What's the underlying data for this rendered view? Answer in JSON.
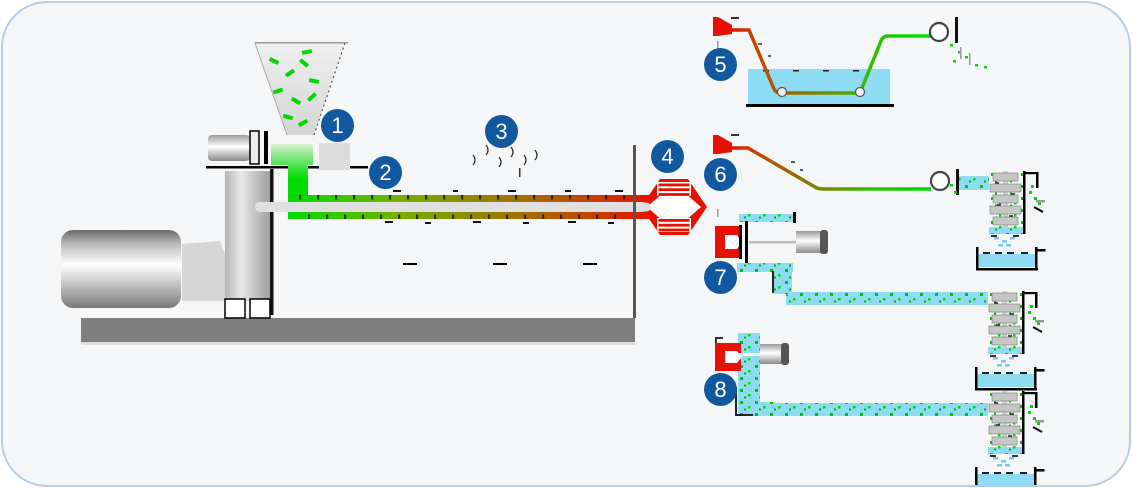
{
  "diagram": {
    "name": "plastic-extrusion-and-pelletizing-process-diagram"
  },
  "colors": {
    "badge_blue": "#11589e",
    "pellet_green": "#00d900",
    "melt_red": "#e81000",
    "water_blue": "#8edcf4",
    "machine_light_gray": "#d9d9d9",
    "base_gray": "#7f7f7f",
    "panel_bg": "#f5f6f7",
    "panel_border": "#b6cde6"
  },
  "steps": [
    {
      "number": "1",
      "name": "material-hopper"
    },
    {
      "number": "2",
      "name": "screw-and-barrel"
    },
    {
      "number": "3",
      "name": "barrel-heating"
    },
    {
      "number": "4",
      "name": "die-head"
    },
    {
      "number": "5",
      "name": "water-bath-strand-pelletizing"
    },
    {
      "number": "6",
      "name": "air-cooled-strand-pelletizing"
    },
    {
      "number": "7",
      "name": "water-ring-pelletizing"
    },
    {
      "number": "8",
      "name": "underwater-pelletizing"
    }
  ]
}
